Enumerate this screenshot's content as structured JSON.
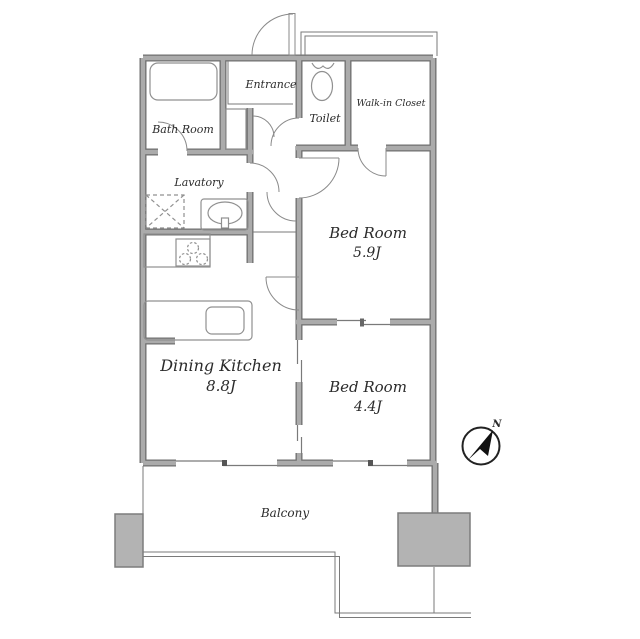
{
  "rooms": {
    "bath": {
      "label": "Bath Room"
    },
    "entrance": {
      "label": "Entrance"
    },
    "toilet": {
      "label": "Toilet"
    },
    "walk_in_closet": {
      "label": "Walk-in Closet"
    },
    "lavatory": {
      "label": "Lavatory"
    },
    "bedroom1": {
      "label": "Bed Room",
      "size": "5.9J"
    },
    "dining_kitchen": {
      "label": "Dining Kitchen",
      "size": "8.8J"
    },
    "bedroom2": {
      "label": "Bed Room",
      "size": "4.4J"
    },
    "balcony": {
      "label": "Balcony"
    }
  },
  "compass": {
    "label": "N"
  },
  "fixtures": [
    "bathtub",
    "toilet-bowl",
    "washing-machine-space",
    "lavatory-sink",
    "stove",
    "kitchen-sink",
    "pillar",
    "balcony-railing"
  ],
  "colors": {
    "wall_fill": "#ababab",
    "wall_edge": "#6f6f6f",
    "thin_line": "#7a7a7a",
    "fixture_line": "#909090",
    "pillar_fill": "#b3b3b3",
    "text": "#2b2b2b",
    "background": "#ffffff"
  }
}
